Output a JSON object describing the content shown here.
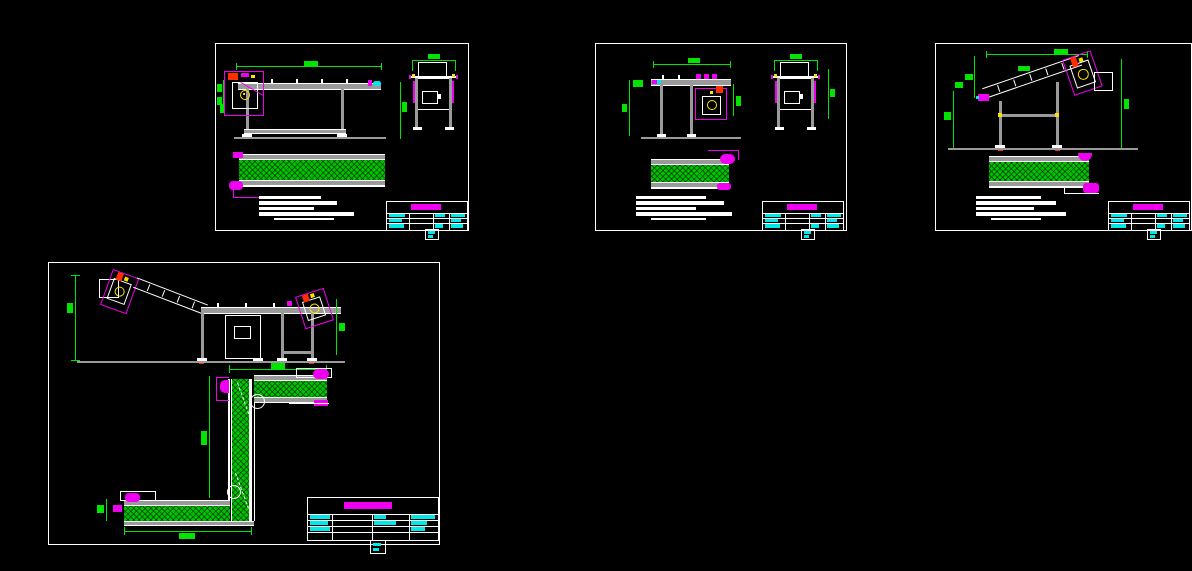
{
  "document": {
    "type": "cad-drawing-canvas",
    "background": "#000000",
    "sheet_count": 4,
    "visible_text_note": "all drawing text is sub-legible raster blocks (dimensions, notes, title-block entries)"
  },
  "palette": {
    "sheet_frame": "#ffffff",
    "geometry_lines": "#9a9a9a",
    "dimension_green": "#00e400",
    "detail_magenta": "#f000f0",
    "title_text_cyan": "#00e8e8",
    "belt_hatch_green": "#00c400",
    "motor_yellow": "#ffe000",
    "marker_red": "#ff2d00"
  },
  "sheets": [
    {
      "id": "sheet-1",
      "position": "top-left",
      "views": [
        "side-elevation",
        "end-elevation",
        "plan-belt"
      ],
      "has_notes": true,
      "has_title_block": true
    },
    {
      "id": "sheet-2",
      "position": "top-middle",
      "views": [
        "side-elevation",
        "end-elevation",
        "plan-belt"
      ],
      "has_notes": true,
      "has_title_block": true
    },
    {
      "id": "sheet-3",
      "position": "top-right",
      "views": [
        "inclined-side-elevation",
        "plan-belt"
      ],
      "has_notes": true,
      "has_title_block": true
    },
    {
      "id": "sheet-4",
      "position": "bottom-left",
      "views": [
        "combined-side-elevation",
        "z-shaped-plan"
      ],
      "has_notes": false,
      "has_title_block": true
    }
  ]
}
